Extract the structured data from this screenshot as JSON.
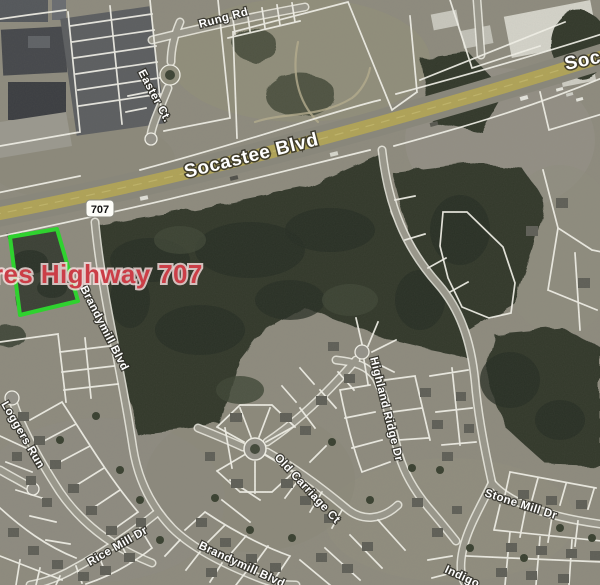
{
  "map": {
    "parcel_label": {
      "text": "res Highway 707",
      "color": "#cb3e47"
    },
    "highlight": {
      "color": "#2fd22f"
    },
    "route_shield": {
      "number": "707"
    },
    "roads": {
      "socastee": "Socastee Blvd",
      "socastee_partial": "Soca",
      "rung": "Rung Rd",
      "easter": "Easter Ct.",
      "brandymill_upper": "Brandymill Blvd",
      "brandymill_lower": "Brandymill Blvd",
      "loggers": "Loggers Run",
      "rice_mill": "Rice Mill Dr",
      "old_carriage": "Old Carriage Ct",
      "highland_ridge": "Highland Ridge Dr",
      "stone_mill": "Stone Mill Dr",
      "indigo_partial": "Indigo"
    },
    "colors": {
      "highway_fill": "#b1a457"
    }
  }
}
